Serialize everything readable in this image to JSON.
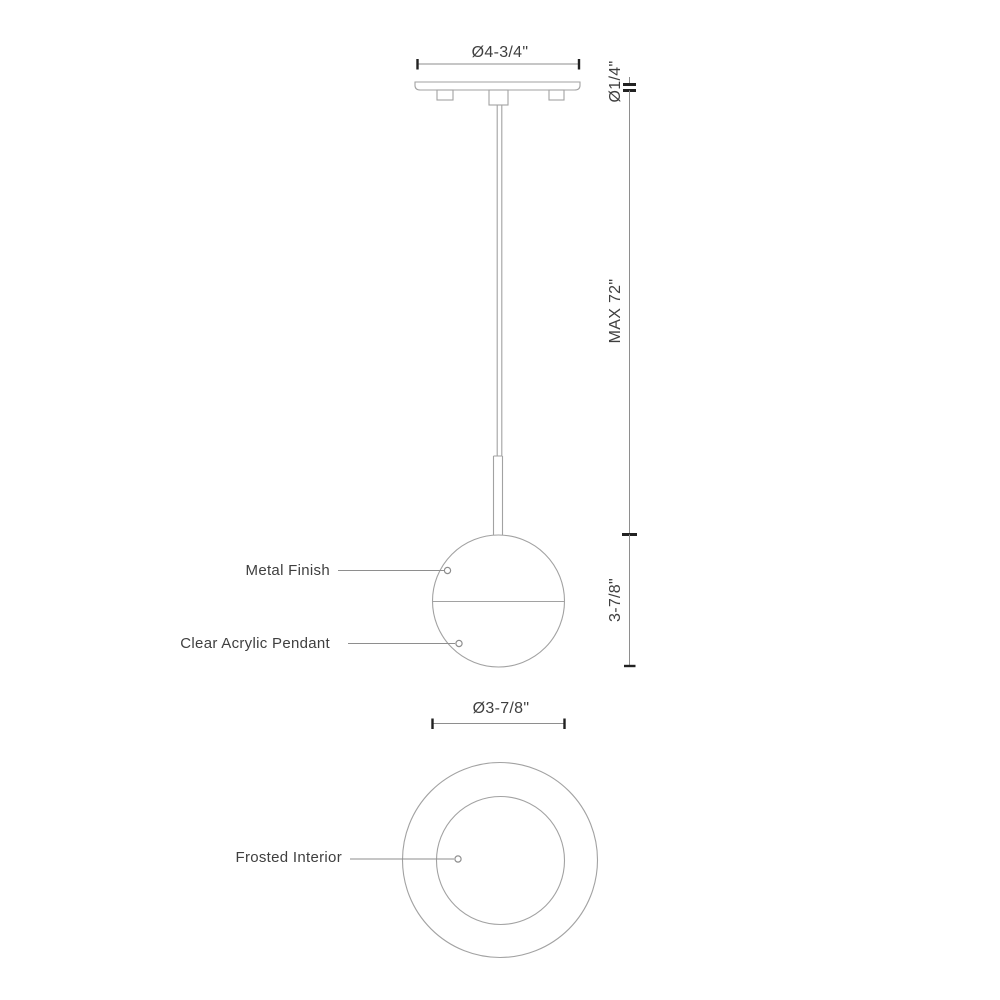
{
  "drawing": {
    "type": "pendant-light-dimension-drawing",
    "side_view": {
      "canopy_diameter_label": "Ø4-3/4\"",
      "cord_diameter_label": "Ø1/4\"",
      "max_drop_label": "MAX 72\"",
      "pendant_height_label": "3-7/8\"",
      "callouts": {
        "metal_finish": "Metal Finish",
        "clear_acrylic": "Clear Acrylic Pendant"
      }
    },
    "bottom_view": {
      "pendant_diameter_label": "Ø3-7/8\"",
      "callouts": {
        "frosted_interior": "Frosted Interior"
      }
    }
  },
  "colors": {
    "bg": "#ffffff",
    "outline": "#a2a2a2",
    "dim": "#8e8e8e",
    "tick": "#222222",
    "text": "#3f3f3f"
  }
}
